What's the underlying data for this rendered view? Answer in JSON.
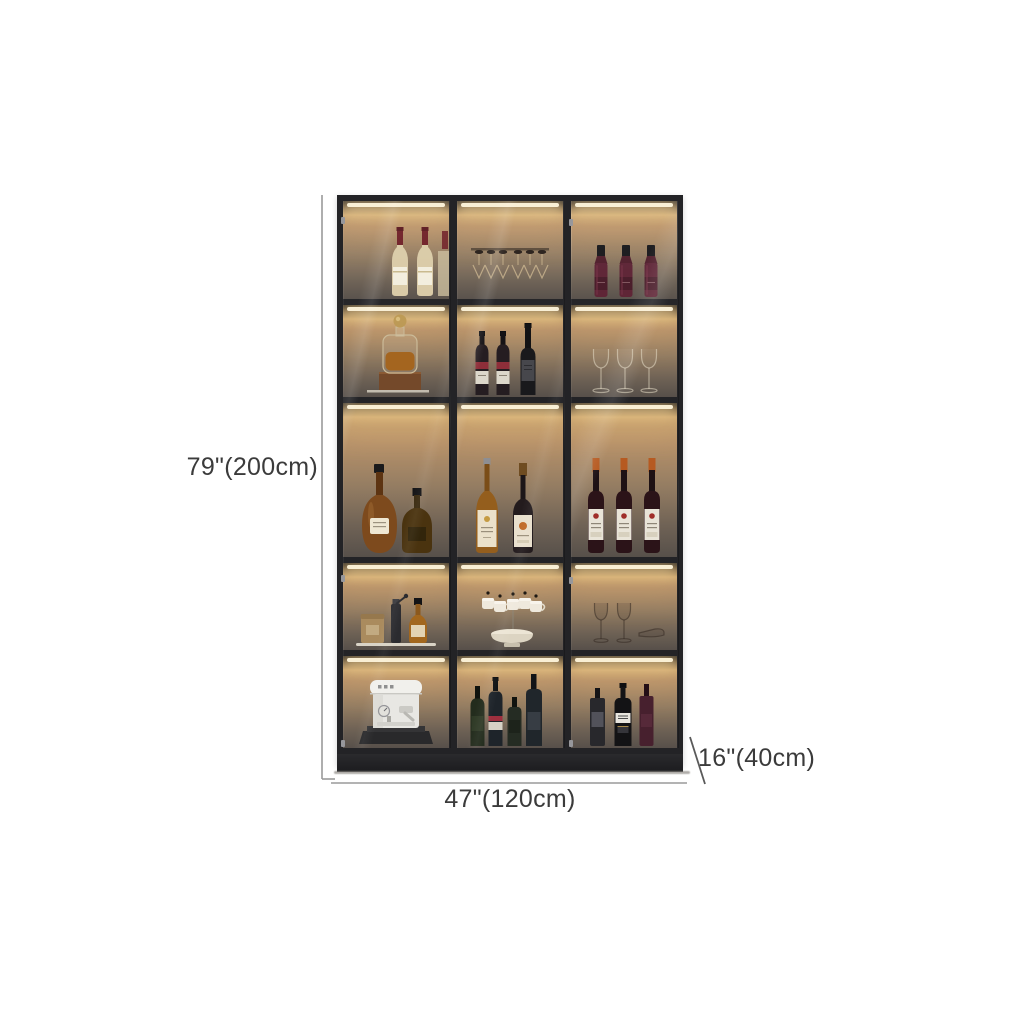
{
  "page": {
    "background": "#ffffff"
  },
  "dimensions": {
    "height": "79\"(200cm)",
    "width": "47\"(120cm)",
    "depth": "16\"(40cm)"
  },
  "cabinet": {
    "description": "3-door glass display wine cabinet with interior LED strip lighting, 5 shelf rows",
    "columns": 3,
    "rows": 5,
    "colors": {
      "frame": "#232326",
      "led_strip": "#f9efd4",
      "interior_glow": "#c9a470",
      "interior_shadow": "#57504a",
      "base": "#1f1f22",
      "dimension_line": "#9a9a9a",
      "dimension_text": "#3b3b3b"
    },
    "shelf_contents": [
      {
        "row": 1,
        "items": [
          "white wine bottles",
          "hanging stemware glasses",
          "dark red liquor bottles"
        ]
      },
      {
        "row": 2,
        "items": [
          "whiskey decanter on wooden box",
          "red wine and port bottles",
          "empty wine glasses"
        ]
      },
      {
        "row": 3,
        "items": [
          "cognac and brandy bottles",
          "labeled wine bottles",
          "red wine bottles with white labels"
        ]
      },
      {
        "row": 4,
        "items": [
          "canister, coffee grinder and whiskey bottle",
          "white mugs on mug tree with bowl",
          "wine glasses"
        ]
      },
      {
        "row": 5,
        "items": [
          "white espresso machine",
          "dark spirit bottles",
          "whisky bottles"
        ]
      }
    ]
  }
}
